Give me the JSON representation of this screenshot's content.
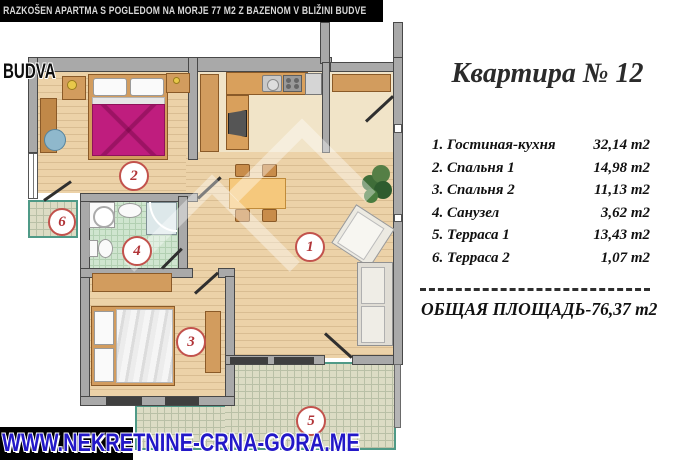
{
  "banner": {
    "text": "RAZKOŠEN APARTMA S POGLEDOM NA MORJE 77 M2 Z BAZENOM V BLIŽINI BUDVE"
  },
  "overlays": {
    "location_label": "BUDVA",
    "website": "WWW.NEKRETNINE-CRNA-GORA.ME"
  },
  "panel": {
    "title": "Квартира № 12",
    "rooms": [
      {
        "label": "1. Гостиная-кухня",
        "area": "32,14 m2"
      },
      {
        "label": "2. Спальня 1",
        "area": "14,98 m2"
      },
      {
        "label": "3. Спальня 2",
        "area": "11,13 m2"
      },
      {
        "label": "4. Санузел",
        "area": "3,62 m2"
      },
      {
        "label": "5. Терраса 1",
        "area": "13,43 m2"
      },
      {
        "label": "6. Терраса 2",
        "area": "1,07 m2"
      }
    ],
    "total": "ОБЩАЯ ПЛОЩАДЬ-76,37 m2"
  },
  "floorplan": {
    "markers": [
      "1",
      "2",
      "3",
      "4",
      "5",
      "6"
    ],
    "colors": {
      "wall": "#a9a9a9",
      "wood_floor": "#ecd2a8",
      "bath_tile": "#cfe5cf",
      "terrace_tile": "#dcdcc4",
      "terrace_border": "#4f9a87",
      "marker_red": "#c2524c",
      "bed_cover_magenta": "#bf1d7e",
      "furniture_wood": "#d29c5e",
      "website_blue": "#2318c8"
    }
  }
}
